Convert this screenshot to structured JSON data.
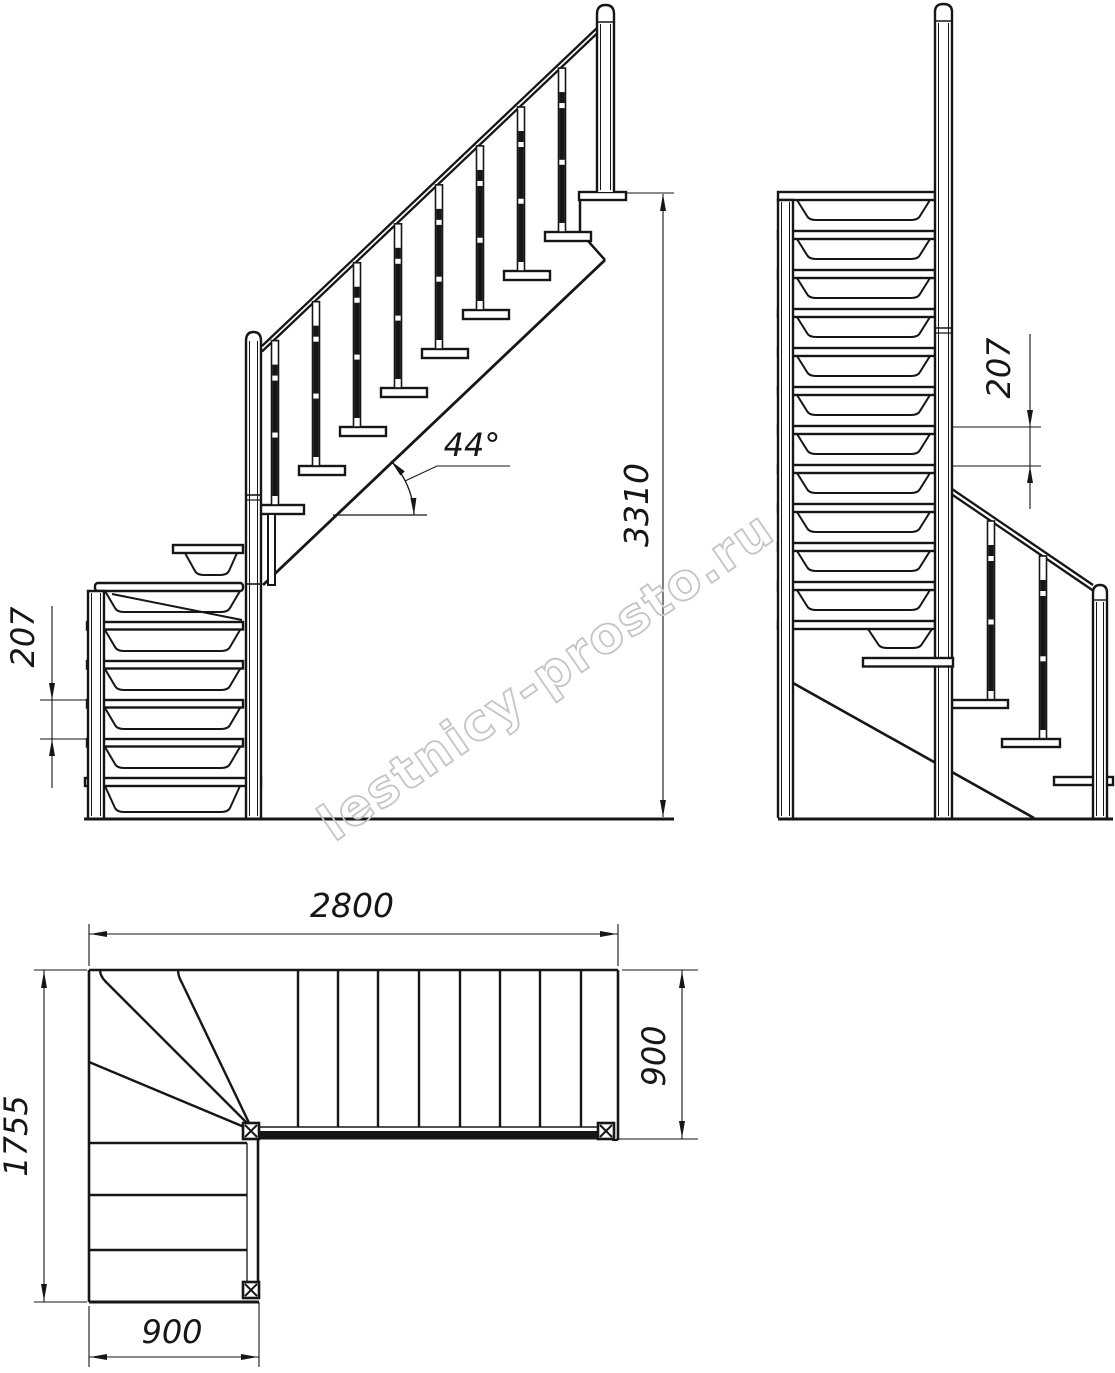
{
  "watermark": {
    "text": "lestnicy-prosto.ru",
    "color": "#c5c5c5"
  },
  "drawing": {
    "ink": "#161616",
    "background": "#ffffff"
  },
  "views": {
    "side_elevation": {
      "riser_height_label": "207",
      "slope_angle_label": "44°",
      "total_height_label": "3310"
    },
    "front_elevation": {
      "riser_height_label": "207"
    },
    "plan": {
      "total_run_label": "2800",
      "flight_width_label": "900",
      "total_depth_label": "1755",
      "lower_flight_width_label": "900"
    }
  }
}
